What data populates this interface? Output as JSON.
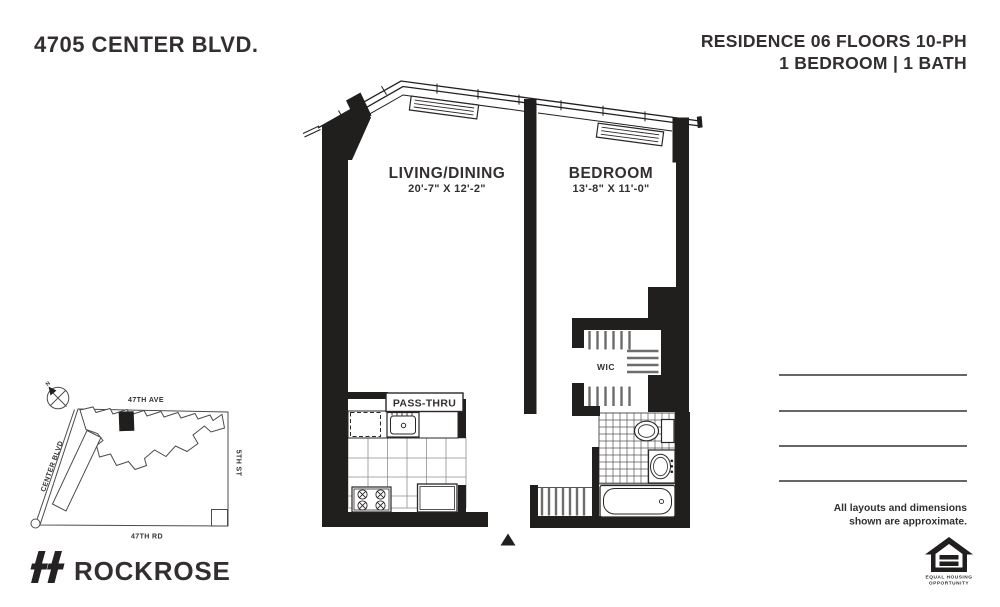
{
  "header": {
    "building": "4705 CENTER BLVD.",
    "residence": "RESIDENCE 06 FLOORS 10-PH",
    "unit_info": "1 BEDROOM | 1 BATH"
  },
  "floor_plan": {
    "living": {
      "name": "LIVING/DINING",
      "dims": "20'-7\" X 12'-2\""
    },
    "bedroom": {
      "name": "BEDROOM",
      "dims": "13'-8\" X 11'-0\""
    },
    "wic_label": "WIC",
    "pass_thru_label": "PASS-THRU"
  },
  "site_map": {
    "street_top": "47TH AVE",
    "street_left": "CENTER BLVD",
    "street_right": "5TH ST",
    "street_bottom": "47TH RD",
    "compass_north": "N"
  },
  "footer": {
    "brand": "ROCKROSE",
    "disclaimer_line1": "All layouts and dimensions",
    "disclaimer_line2": "shown are approximate.",
    "eho_caption_line1": "EQUAL HOUSING",
    "eho_caption_line2": "OPPORTUNITY"
  },
  "colors": {
    "ink": "#211e1e",
    "text": "#332f30",
    "note_line": "#666666"
  }
}
